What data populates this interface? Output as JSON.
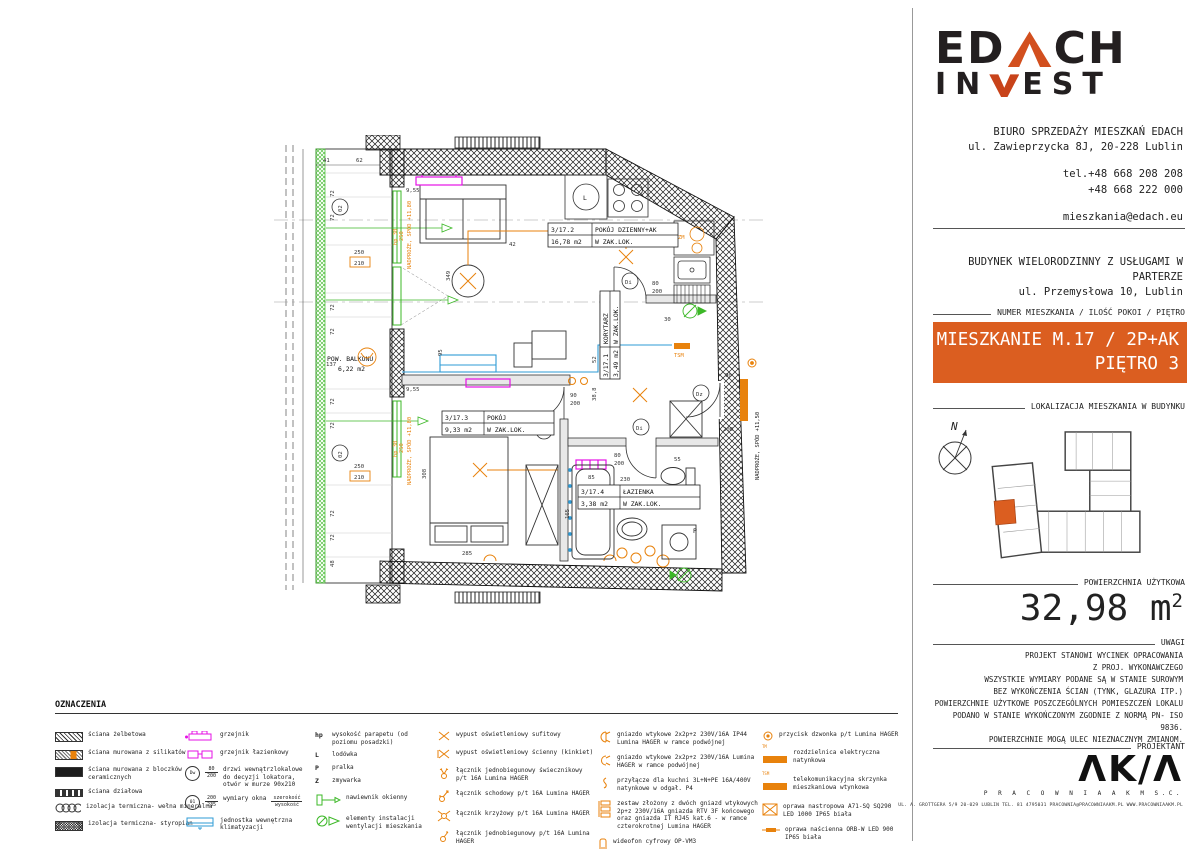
{
  "sidebar": {
    "logo": {
      "p1": "ED",
      "p2": "CH",
      "p3": "IN",
      "p4": "EST"
    },
    "office1": "BIURO SPRZEDAŻY MIESZKAŃ EDACH",
    "office2": "ul. Zawieprzycka 8J, 20-228 Lublin",
    "phone1": "tel.+48 668 208 208",
    "phone2": "+48 668 222 000",
    "email": "mieszkania@edach.eu",
    "building1": "BUDYNEK WIELORODZINNY Z USŁUGAMI W PARTERZE",
    "building2": "ul. Przemysłowa 10, Lublin",
    "unit_label": "NUMER MIESZKANIA / ILOŚĆ POKOI / PIĘTRO",
    "unit_line1": "MIESZKANIE M.17 / 2P+AK",
    "unit_line2": "PIĘTRO 3",
    "location_label": "LOKALIZACJA MIESZKANIA W BUDYNKU",
    "compass_n": "N",
    "area_label": "POWIERZCHNIA UŻYTKOWA",
    "area_value": "32,98",
    "area_unit": "m",
    "area_sup": "2",
    "notes_label": "UWAGI",
    "notes": [
      "PROJEKT STANOWI WYCINEK OPRACOWANIA",
      "Z PROJ. WYKONAWCZEGO",
      "WSZYSTKIE WYMIARY PODANE SĄ W STANIE SUROWYM",
      "BEZ WYKOŃCZENIA ŚCIAN (TYNK, GLAZURA ITP.)",
      "POWIERZCHNIE UŻYTKOWE POSZCZEGÓLNYCH POMIESZCZEŃ LOKALU",
      "PODANO W STANIE WYKOŃCZONYM ZGODNIE Z NORMĄ PN- ISO 9836.",
      "POWIERZCHNIE MOGĄ ULEC NIEZNACZNYM ZMIANOM."
    ],
    "designer_label": "PROJEKTANT",
    "designer_logo": "ΛK/Λ",
    "designer_name": "P R A C O W N I A   A K M   S.C.",
    "designer_footer": "UL. A. GROTTGERA 5/9   20-029 LUBLIN   TEL. 81 4795031   PRACOWNIA@PRACOWNIAAKM.PL   WWW.PRACOWNIAAKM.PL"
  },
  "plan": {
    "rooms": {
      "living": {
        "num": "3/17.2",
        "name": "POKÓJ DZIENNY+AK",
        "area": "16,78 m2",
        "note": "W ZAK.LOK."
      },
      "bedroom": {
        "num": "3/17.3",
        "name": "POKÓJ",
        "area": "9,33 m2",
        "note": "W ZAK.LOK."
      },
      "corridor": {
        "num": "3/17.1",
        "name": "KORYTARZ",
        "area": "3,49 m2",
        "note": "W ZAK.LOK."
      },
      "bath": {
        "num": "3/17.4",
        "name": "ŁAZIENKA",
        "area": "3,38 m2",
        "note": "W ZAK.LOK."
      }
    },
    "texts": {
      "pow_balkonu": "POW. BALKONU",
      "balkon_area": "6,22 m2",
      "nadproze80": "NADPROŻE, SPÓD +11,80",
      "nadproze50": "NADPROŻE, SPÓD +11,50",
      "hp30": "hp 30",
      "h250": "250",
      "zm": "ZM",
      "tsm": "TSM",
      "fridge": "L",
      "washer": "P",
      "di": "Di",
      "dz": "Dz",
      "win02": "02"
    },
    "dims": {
      "d41": "41",
      "d62": "62",
      "d72": "72",
      "d137": "137",
      "d250": "250",
      "d210": "210",
      "d48": "48",
      "d955": "9,55",
      "d349": "349",
      "d95": "95",
      "d308": "308",
      "d285": "285",
      "d165": "165",
      "d230": "230",
      "d85": "85",
      "d55": "55",
      "d90": "90",
      "d80": "80",
      "d200": "200",
      "d388": "38,8",
      "d52": "52",
      "d42": "42",
      "d30": "30"
    }
  },
  "legend": {
    "title": "OZNACZENIA",
    "col1": [
      {
        "label": "ściana żelbetowa"
      },
      {
        "label": "ściana murowana z silikatów"
      },
      {
        "label": "ściana murowana z bloczków ceramicznych"
      },
      {
        "label": "ściana działowa"
      },
      {
        "label": "izolacja termiczna- wełna mineralna"
      },
      {
        "label": "izolacja termiczna- styropian"
      }
    ],
    "col2": [
      {
        "label": "grzejnik"
      },
      {
        "label": "grzejnik łazienkowy"
      },
      {
        "circ": "Dw",
        "ft": "80",
        "fb": "200",
        "label": "drzwi wewnątrzlokalowe do decyzji lokatora, otwór w murze 90x210"
      },
      {
        "circ": "01",
        "ft": "200",
        "fb": "235",
        "label": "wymiary okna",
        "et": "szerokość",
        "eb": "wysokość"
      },
      {
        "label": "jednostka wewnętrzna klimatyzacji"
      }
    ],
    "col3": [
      {
        "sym": "hp",
        "label": "wysokość parapetu (od poziomu posadzki)"
      },
      {
        "sym": "L",
        "label": "lodówka"
      },
      {
        "sym": "P",
        "label": "pralka"
      },
      {
        "sym": "Z",
        "label": "zmywarka"
      },
      {
        "label": "nawiewnik okienny"
      },
      {
        "label": "elementy instalacji wentylacji mieszkania"
      }
    ],
    "col4": [
      {
        "label": "wypust oświetleniowy sufitowy"
      },
      {
        "label": "wypust oświetleniowy ścienny (kinkiet)"
      },
      {
        "label": "łącznik jednobiegunowy świecznikowy  p/t 16A Lumina HAGER"
      },
      {
        "label": "łącznik schodowy  p/t 16A Lumina HAGER"
      },
      {
        "label": "łącznik krzyżowy  p/t 16A Lumina HAGER"
      },
      {
        "label": "łącznik jednobiegunowy p/t 16A Lumina HAGER"
      }
    ],
    "col5": [
      {
        "label": "gniazdo wtykowe 2x2p+z 230V/16A IP44 Lumina HAGER w ramce podwójnej"
      },
      {
        "label": "gniazdo wtykowe 2x2p+z 230V/16A Lumina HAGER w ramce podwójnej"
      },
      {
        "label": "przyłącze dla kuchni 3L+N+PE 16A/400V natynkowe w odgał. P4"
      },
      {
        "label": "zestaw złożony z dwóch gniazd wtykowych 2p+z 230V/16A gniazda RTV 3F końcowego oraz gniazda IT RJ45 kat.6 - w ramce czterokrotnej Lumina HAGER"
      },
      {
        "label": "wideofon cyfrowy OP-VM3"
      }
    ],
    "col6": [
      {
        "label": "przycisk dzwonka p/t Lumina HAGER"
      },
      {
        "tag": "TM",
        "label": "rozdzielnica elektryczna natynkowa"
      },
      {
        "tag": "TSM",
        "label": "telekomunikacyjna skrzynka mieszkaniowa wtynkowa"
      },
      {
        "label": "oprawa nastropowa A71-SQ SQ290 LED 1000 IP65 biała"
      },
      {
        "label": "oprawa naścienna ORB-W LED 900 IP65 biała"
      },
      {
        "label": "gniazdo wtykowe 2p+z IP55 szare p/t odporne na UV PLEX055 Legrand (balkon)"
      }
    ]
  },
  "colors": {
    "accent": "#db5e20",
    "electrical": "#e8820c",
    "window_green": "#3cb827",
    "radiator": "#e511e5",
    "hvac": "#2e9bd6"
  }
}
